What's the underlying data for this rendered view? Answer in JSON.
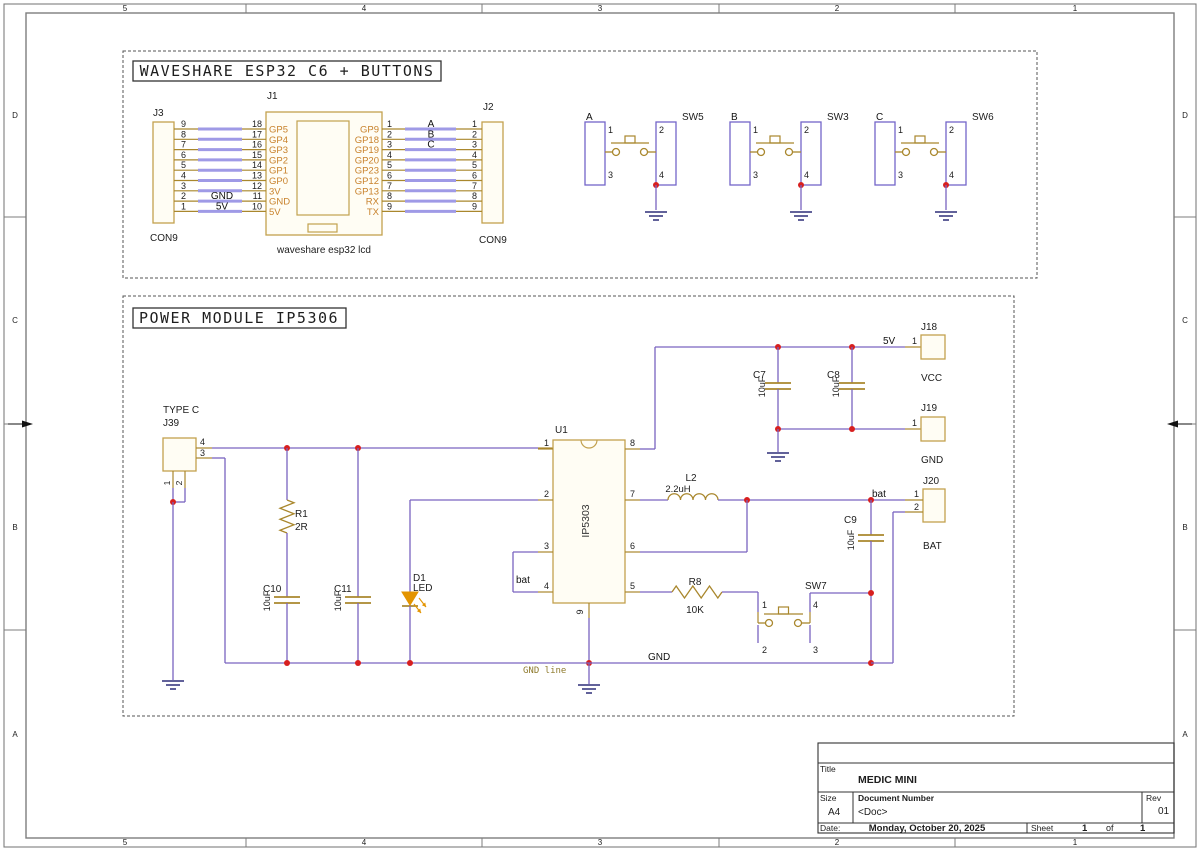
{
  "colors": {
    "wire": "#7a63c0",
    "highlight": "#9f9ae6",
    "pin": "#a9872d",
    "comp": "#c2a14e",
    "comp_fill": "#fffdf4",
    "junction": "#d71f1f",
    "body": "#7465c8",
    "led": "#e39400",
    "ground": "#2e2e78",
    "text": "#1d1d1d",
    "pin_name": "#c8822c",
    "frame": "#7d7d7d",
    "net_text": "#111111",
    "olive": "#8f7b2e"
  },
  "frame": {
    "cols": [
      "5",
      "4",
      "3",
      "2",
      "1"
    ],
    "rows": [
      "D",
      "C",
      "B",
      "A"
    ]
  },
  "sections": [
    {
      "title": "WAVESHARE ESP32 C6 + BUTTONS"
    },
    {
      "title": "POWER MODULE IP5306"
    }
  ],
  "esp32": {
    "j3": {
      "ref": "J3",
      "type": "CON9",
      "pins": [
        "9",
        "8",
        "7",
        "6",
        "5",
        "4",
        "3",
        "2",
        "1"
      ]
    },
    "j2": {
      "ref": "J2",
      "type": "CON9",
      "pins": [
        "1",
        "2",
        "3",
        "4",
        "5",
        "6",
        "7",
        "8",
        "9"
      ]
    },
    "j1": {
      "ref": "J1",
      "label": "waveshare esp32 lcd",
      "left_nums": [
        "18",
        "17",
        "16",
        "15",
        "14",
        "13",
        "12",
        "11",
        "10"
      ],
      "left_names": [
        "GP5",
        "GP4",
        "GP3",
        "GP2",
        "GP1",
        "GP0",
        "3V",
        "GND",
        "5V"
      ],
      "right_nums": [
        "1",
        "2",
        "3",
        "4",
        "5",
        "6",
        "7",
        "8",
        "9"
      ],
      "right_names": [
        "GP9",
        "GP18",
        "GP19",
        "GP20",
        "GP23",
        "GP12",
        "GP13",
        "RX",
        "TX"
      ]
    },
    "left_nets": {
      "7": "GND",
      "8": "5V"
    },
    "right_nets": [
      "A",
      "B",
      "C"
    ],
    "button_pins": [
      "1",
      "2",
      "3",
      "4"
    ],
    "buttons": [
      {
        "ref": "SW5",
        "net": "A"
      },
      {
        "ref": "SW3",
        "net": "B"
      },
      {
        "ref": "SW6",
        "net": "C"
      }
    ]
  },
  "power": {
    "j39": {
      "ref": "J39",
      "type": "TYPE C",
      "pin_top": "4",
      "pin_mid": "3",
      "pin1": "1",
      "pin2": "2"
    },
    "u1": {
      "ref": "U1",
      "value": "IP5303",
      "left": [
        "1",
        "2",
        "3",
        "4"
      ],
      "right": [
        "8",
        "7",
        "6",
        "5"
      ],
      "bottom": "9"
    },
    "r1": {
      "ref": "R1",
      "value": "2R"
    },
    "r8": {
      "ref": "R8",
      "value": "10K"
    },
    "l2": {
      "ref": "L2",
      "value": "2.2uH"
    },
    "c7": {
      "ref": "C7",
      "value": "10uF"
    },
    "c8": {
      "ref": "C8",
      "value": "10uF"
    },
    "c9": {
      "ref": "C9",
      "value": "10uF"
    },
    "c10": {
      "ref": "C10",
      "value": "10uF"
    },
    "c11": {
      "ref": "C11",
      "value": "10uF"
    },
    "d1": {
      "ref": "D1",
      "value": "LED"
    },
    "sw7": {
      "ref": "SW7",
      "pins": [
        "1",
        "4",
        "2",
        "3"
      ]
    },
    "j18": {
      "ref": "J18",
      "name": "VCC",
      "pin": "1"
    },
    "j19": {
      "ref": "J19",
      "name": "GND",
      "pin": "1"
    },
    "j20": {
      "ref": "J20",
      "name": "BAT",
      "pin1": "1",
      "pin2": "2"
    },
    "nets": {
      "v5": "5V",
      "bat": "bat",
      "gnd": "GND",
      "gnd_line": "GND line"
    }
  },
  "title_block": {
    "title_label": "Title",
    "title": "MEDIC MINI",
    "size_label": "Size",
    "size": "A4",
    "doc_label": "Document Number",
    "doc": "<Doc>",
    "rev_label": "Rev",
    "rev": "01",
    "date_label": "Date:",
    "date": "Monday, October 20, 2025",
    "sheet_label": "Sheet",
    "sheet_no": "1",
    "of_label": "of",
    "sheet_total": "1"
  }
}
